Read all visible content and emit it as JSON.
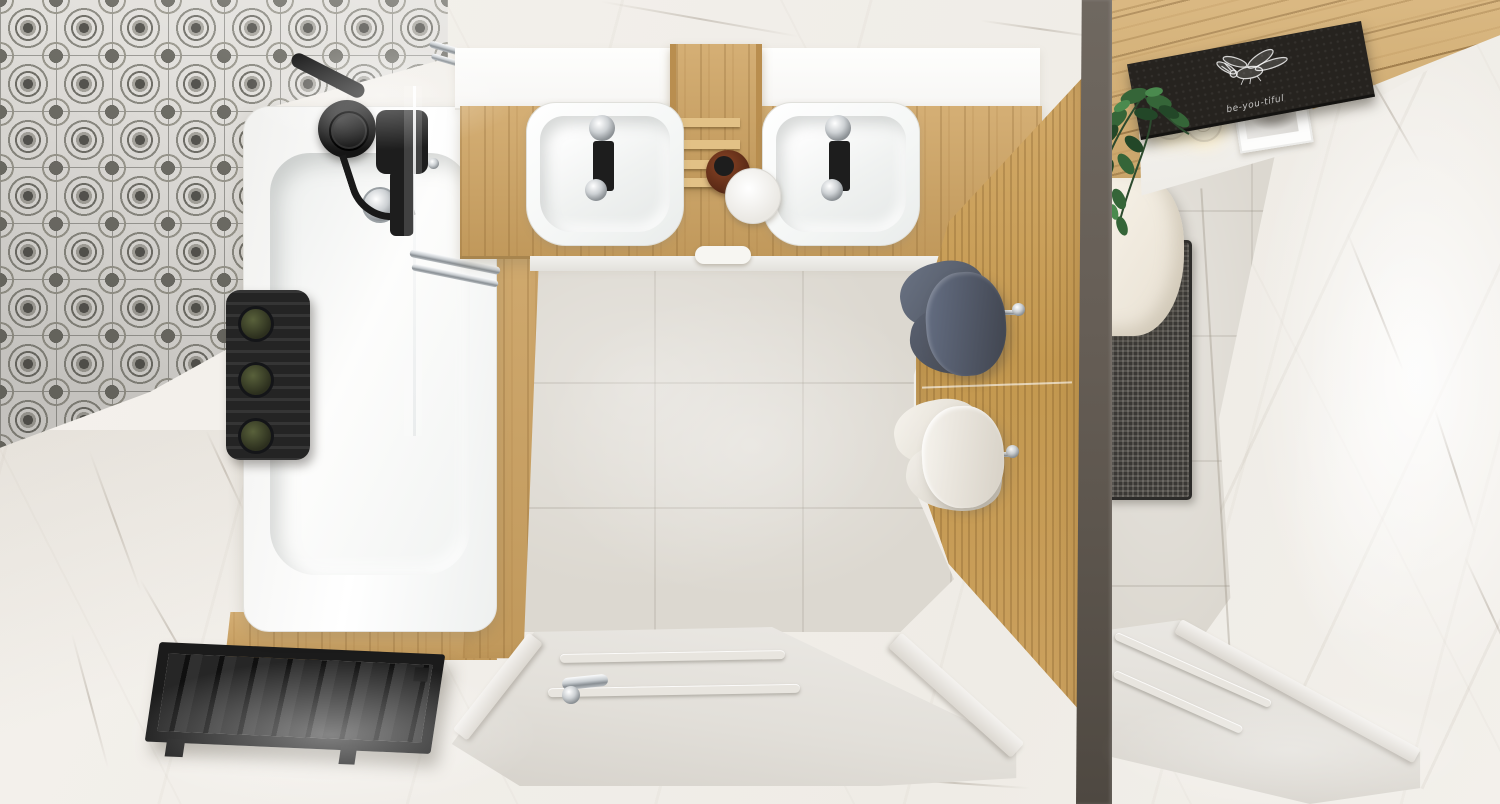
{
  "scene": {
    "type": "3D architectural render, top-down bird's-eye view",
    "description": "Modern bathroom seen from above: bathtub zone with grey ornamental patchwork tile wall, double-sink oak vanity room with concrete-look floor and oak towel wall, and a separate toilet room behind a taupe divider wall. White paneled doors and marble tiles throughout.",
    "rooms": [
      "bathtub-and-vanity-room",
      "toilet-room"
    ]
  },
  "chalkboard": {
    "text": "be-you-tiful",
    "drawing": "white chalk bee sketch"
  },
  "palette": {
    "marble": "#f2efea",
    "marble_vein": "#8a7e6e",
    "oak_wood": "#cfa462",
    "concrete_floor": "#dcd8d0",
    "pattern_tile_grey": "#706f68",
    "matte_black": "#1d1d1d",
    "divider_wall": "#5f5850",
    "dark_towel": "#596069",
    "white_towel": "#efece6",
    "toilet_cream": "#f2ecdf",
    "chrome": "#c6cbcf",
    "bottle_green": "#3f4a2c",
    "chalkboard_black": "#26231f"
  },
  "objects": [
    "patterned-tile-wall",
    "bathtub",
    "black-shower-mixer",
    "shower-caddy-with-bottles",
    "glass-screen",
    "chrome-towel-bar",
    "tub-drain",
    "wood-tub-apron",
    "black-slat-bench",
    "double-sink-vanity",
    "left-basin",
    "right-basin",
    "oak-ladder-shelf",
    "amber-jar",
    "white-dish",
    "mirror-shelf-band",
    "concrete-floor",
    "oak-accent-wall",
    "dark-grey-towel",
    "white-towel",
    "chrome-hooks",
    "white-paneled-door",
    "chrome-door-handle",
    "divider-wall",
    "oak-plank-wall",
    "chalkboard-bee-art",
    "glowing-candles",
    "framed-sketch",
    "trailing-plant",
    "toilet",
    "textured-dark-mat",
    "marble-wall",
    "second-white-door"
  ]
}
